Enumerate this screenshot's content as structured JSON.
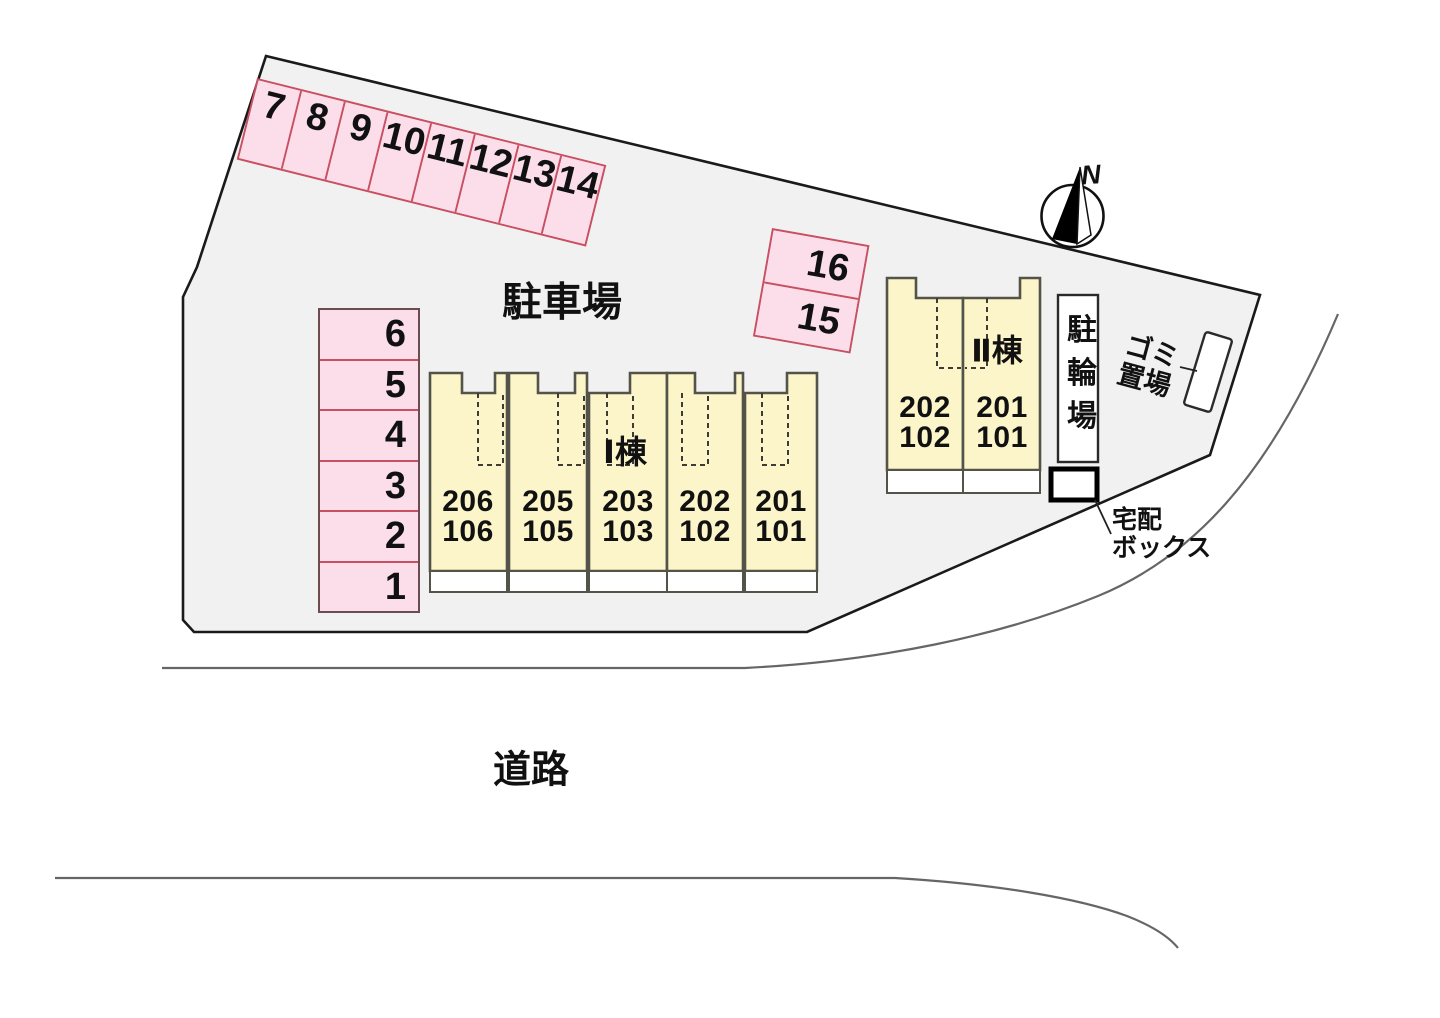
{
  "title": "site-plan",
  "labels": {
    "parking_lot": "駐車場",
    "road": "道路",
    "north": "N",
    "bike_parking": "駐輪場",
    "garbage_area": "ゴミ\n置場",
    "delivery_box": "宅配\nボックス"
  },
  "buildings": [
    {
      "name": "Ⅰ棟",
      "units": [
        {
          "upper": "206",
          "lower": "106"
        },
        {
          "upper": "205",
          "lower": "105"
        },
        {
          "upper": "203",
          "lower": "103"
        },
        {
          "upper": "202",
          "lower": "102"
        },
        {
          "upper": "201",
          "lower": "101"
        }
      ]
    },
    {
      "name": "Ⅱ棟",
      "units": [
        {
          "upper": "202",
          "lower": "102"
        },
        {
          "upper": "201",
          "lower": "101"
        }
      ]
    }
  ],
  "parking_spaces": {
    "top_row": [
      "7",
      "8",
      "9",
      "10",
      "11",
      "12",
      "13",
      "14"
    ],
    "side_block": [
      "16",
      "15"
    ],
    "left_column": [
      "6",
      "5",
      "4",
      "3",
      "2",
      "1"
    ]
  },
  "colors": {
    "site_fill": "#f1f1f1",
    "site_border": "#1a1a1a",
    "parking_fill": "#fbdee9",
    "parking_border": "#c94f63",
    "building_fill": "#fcf5c9",
    "building_border": "#53534a",
    "road_line": "#666666"
  }
}
